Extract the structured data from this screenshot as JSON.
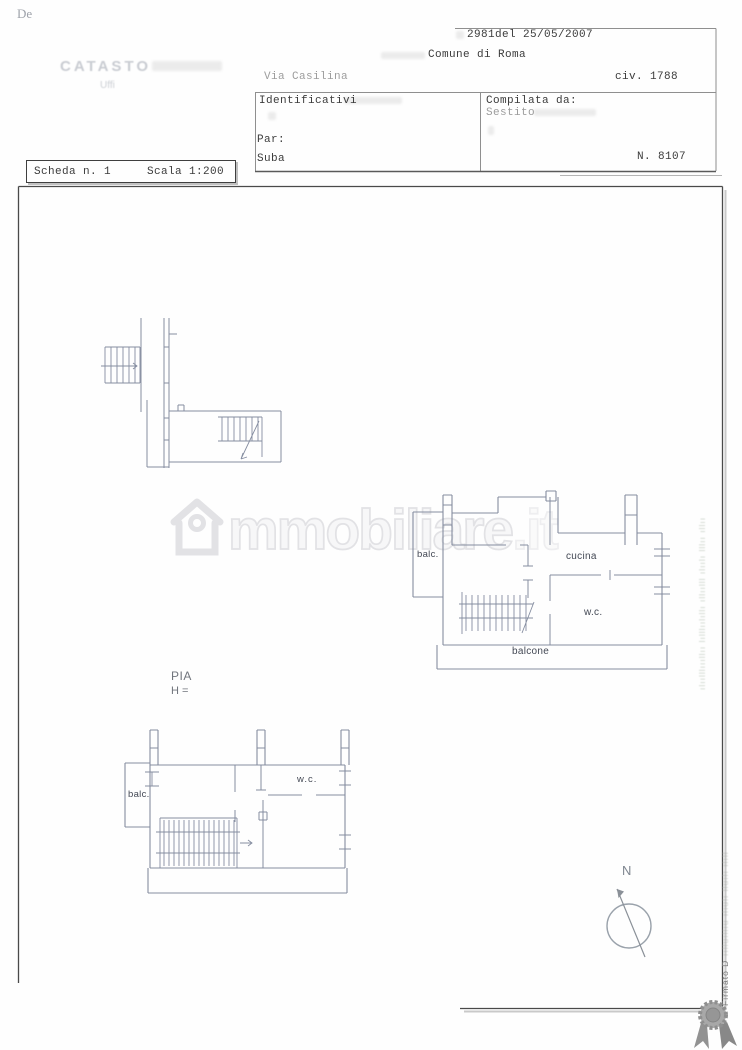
{
  "header": {
    "corner_note": "De",
    "protocol": "2981del 25/05/2007",
    "catasto_faint": "CATASTO",
    "catasto_sub_faint": "Uffi",
    "comune": "Comune di Roma",
    "street_faint": "Via Casilina",
    "civic": "civ. 1788",
    "identificativi_label": "Identificativi",
    "particella_label": "Par:",
    "subalterno_label": "Suba",
    "compilata_label": "Compilata da:",
    "compilata_name_faint": "Sestito",
    "sheet_number": "N. 8107"
  },
  "scheda_box": {
    "scheda": "Scheda n. 1",
    "scala": "Scala 1:200"
  },
  "watermark": {
    "icon": "house-icon",
    "text_main": "mmobiliare",
    "text_suffix": ".it"
  },
  "plan_labels": {
    "piano": "PIA",
    "altezza": "H =",
    "plan2_balc": "balc.",
    "plan2_cucina": "cucina",
    "plan2_wc": "w.c.",
    "plan2_balcone": "balcone",
    "plan3_balc": "balc.",
    "plan3_wc": "w.c."
  },
  "compass": {
    "north_label": "N"
  },
  "side_stamps": {
    "green_stamp_illegible": "ılıılllıııllıı lılllıılıllı ıllıılll ılıılı lllıı ıllıı",
    "firmato": "Firmato D",
    "firmato_tail_illegible": "ıılluıllıu ılıulı lluılı ılıll"
  },
  "colors": {
    "plan_line": "#858da0",
    "border": "#4a4a4a",
    "stamp_green": "#9fae9c",
    "watermark_outline": "#e2e2e5"
  }
}
